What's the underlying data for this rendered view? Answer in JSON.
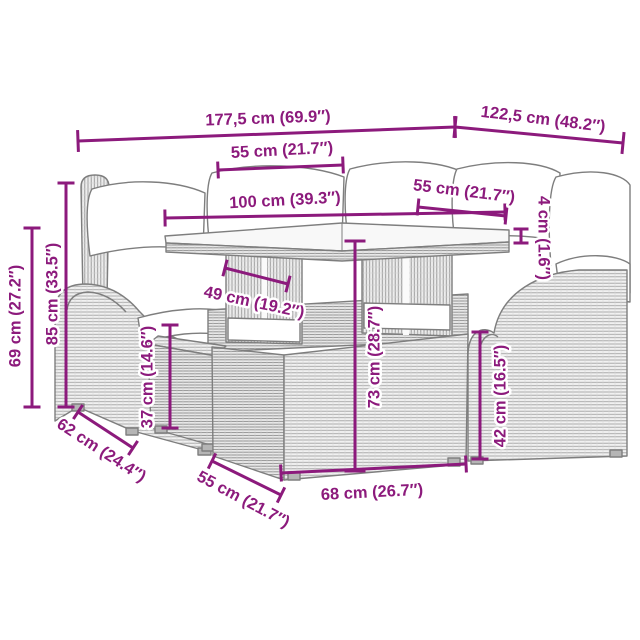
{
  "meta": {
    "title": "Garden furniture set dimension diagram",
    "canvas_width": 640,
    "canvas_height": 640,
    "background": "#ffffff"
  },
  "style": {
    "dimension_color": "#8c1a7c",
    "line_art_color": "#7e7e7e",
    "cushion_color": "#ffffff",
    "font_size": 16.5,
    "line_width": 3,
    "tick_width": 3
  },
  "furniture": {
    "description": "gray poly-rattan lounge set line art: sofa with white cushions, armchair, glass-top table with two pedestals, small ottoman, large ottoman"
  },
  "dimensions": [
    {
      "id": "overall-width",
      "label": "177,5 cm (69.9″)",
      "x1": 78,
      "y1": 141,
      "x2": 455,
      "y2": 127,
      "tick": 22,
      "lx": 268,
      "ly": 119,
      "rot": -2
    },
    {
      "id": "overall-depth",
      "label": "122,5 cm (48.2″)",
      "x1": 455,
      "y1": 127,
      "x2": 623,
      "y2": 143,
      "tick": 22,
      "lx": 543,
      "ly": 120,
      "rot": 7
    },
    {
      "id": "seat-width-top",
      "label": "55 cm (21.7″)",
      "x1": 218,
      "y1": 170,
      "x2": 343,
      "y2": 165,
      "tick": 17,
      "lx": 282,
      "ly": 151,
      "rot": -3
    },
    {
      "id": "table-length",
      "label": "100 cm (39.3″)",
      "x1": 165,
      "y1": 218,
      "x2": 505,
      "y2": 212,
      "tick": 17,
      "lx": 285,
      "ly": 201,
      "rot": -3
    },
    {
      "id": "seat-width-right",
      "label": "55 cm (21.7″)",
      "x1": 418,
      "y1": 207,
      "x2": 506,
      "y2": 216,
      "tick": 17,
      "lx": 464,
      "ly": 192,
      "rot": 7
    },
    {
      "id": "tabletop-thickness",
      "label": "4 cm (1.6″)",
      "x1": 521,
      "y1": 229,
      "x2": 521,
      "y2": 243,
      "tick": 15,
      "lx": 543,
      "ly": 238,
      "rot": 90
    },
    {
      "id": "back-height",
      "label": "85 cm (33.5″)",
      "x1": 66,
      "y1": 183,
      "x2": 66,
      "y2": 407,
      "tick": 17,
      "lx": 53,
      "ly": 294,
      "rot": -90
    },
    {
      "id": "arm-height",
      "label": "69 cm (27.2″)",
      "x1": 32,
      "y1": 228,
      "x2": 32,
      "y2": 407,
      "tick": 17,
      "lx": 16,
      "ly": 316,
      "rot": -90
    },
    {
      "id": "table-depth",
      "label": "49 cm (19.2″)",
      "x1": 225,
      "y1": 268,
      "x2": 288,
      "y2": 284,
      "tick": 17,
      "lx": 254,
      "ly": 303,
      "rot": 12
    },
    {
      "id": "table-height",
      "label": "73 cm (28.7″)",
      "x1": 355,
      "y1": 241,
      "x2": 355,
      "y2": 471,
      "tick": 21,
      "lx": 375,
      "ly": 357,
      "rot": -90
    },
    {
      "id": "ottoman-height",
      "label": "37 cm (14.6″)",
      "x1": 170,
      "y1": 325,
      "x2": 170,
      "y2": 428,
      "tick": 17,
      "lx": 148,
      "ly": 377,
      "rot": -90
    },
    {
      "id": "seat-height",
      "label": "42 cm (16.5″)",
      "x1": 480,
      "y1": 332,
      "x2": 480,
      "y2": 459,
      "tick": 17,
      "lx": 501,
      "ly": 396,
      "rot": -90
    },
    {
      "id": "sofa-depth",
      "label": "62 cm (24.4″)",
      "x1": 78,
      "y1": 412,
      "x2": 133,
      "y2": 448,
      "tick": 17,
      "lx": 101,
      "ly": 451,
      "rot": 33
    },
    {
      "id": "ottoman-depth",
      "label": "55 cm (21.7″)",
      "x1": 212,
      "y1": 461,
      "x2": 281,
      "y2": 495,
      "tick": 17,
      "lx": 243,
      "ly": 500,
      "rot": 28
    },
    {
      "id": "ottoman-width",
      "label": "68 cm (26.7″)",
      "x1": 281,
      "y1": 473,
      "x2": 466,
      "y2": 464,
      "tick": 17,
      "lx": 372,
      "ly": 493,
      "rot": -3
    }
  ]
}
